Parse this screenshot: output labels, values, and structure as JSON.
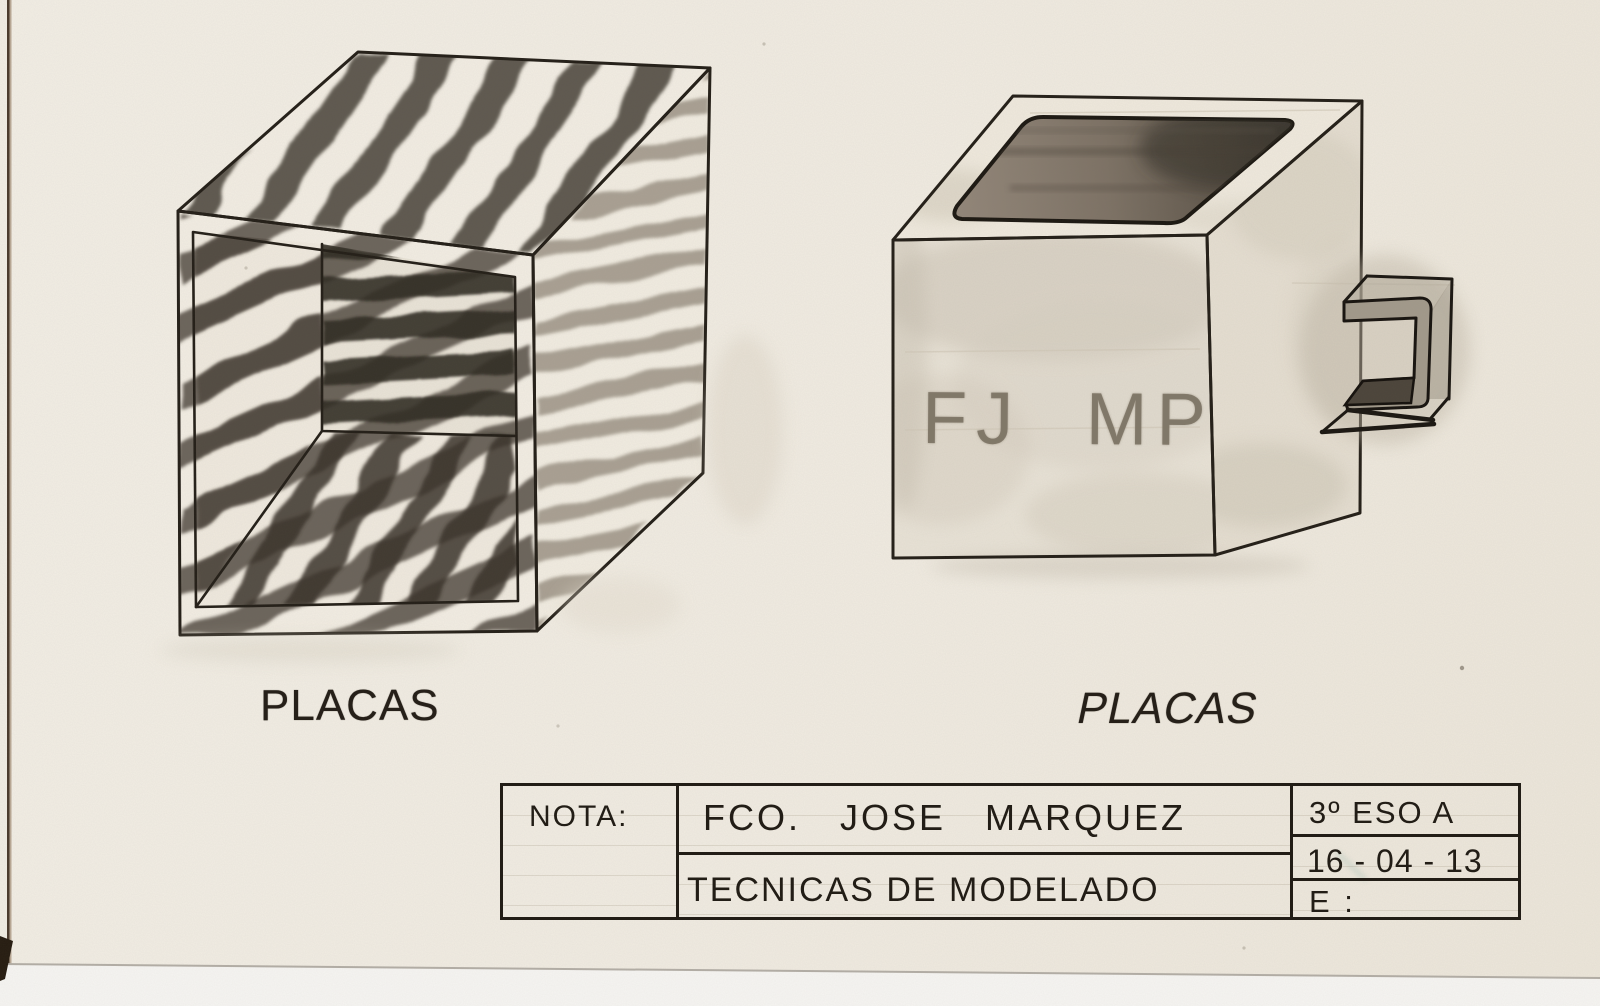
{
  "sheet": {
    "captions": {
      "left": "PLACAS",
      "right": "PLACAS"
    },
    "inscription": "FJ MP",
    "title_block": {
      "nota_label": "NOTA:",
      "author": "FCO. JOSE MARQUEZ",
      "subject": "TECNICAS DE MODELADO",
      "group": "3º ESO A",
      "date": "16 - 04 - 13",
      "scale_label": "E :"
    },
    "palette": {
      "paper": "#f0ebe1",
      "ink": "#241f18",
      "pencil_dark": "#3f3830",
      "pencil_mid": "#6f675d",
      "pencil_light": "#8d8477",
      "scanner_white": "#f6f5f2"
    }
  }
}
